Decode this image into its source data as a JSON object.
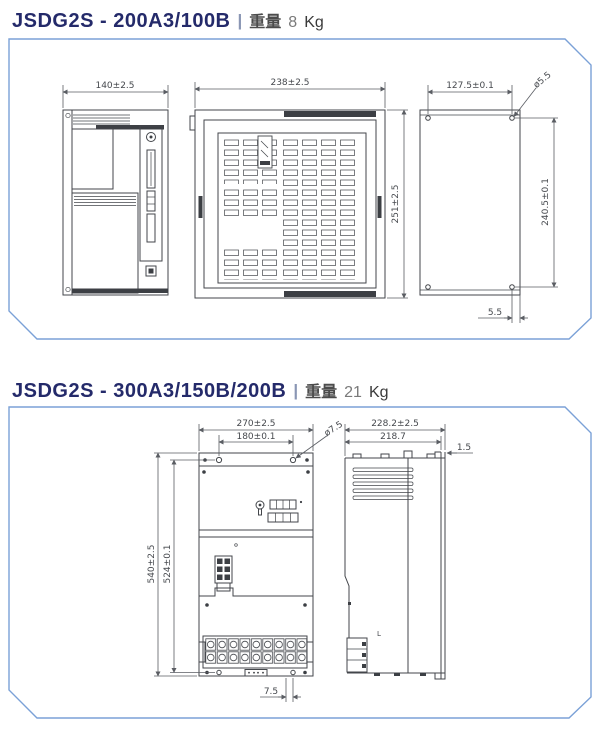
{
  "colors": {
    "model_text": "#242a6a",
    "separator": "#8a96b4",
    "weight_label_text": "#4c4c4c",
    "panel_border": "#7ba1d7",
    "drawing_line": "#43464b",
    "panel_bg": "#ffffff"
  },
  "sections": [
    {
      "title": {
        "model": "JSDG2S - 200A3/100B",
        "sep": "|",
        "weight_label": "重量",
        "weight_value": "8",
        "weight_unit": "Kg"
      },
      "dims": {
        "side_top": "140±2.5",
        "front_top": "238±2.5",
        "front_right": "251±2.5",
        "back_top": "127.5±0.1",
        "back_hole": "ø5.5",
        "back_right": "240.5±0.1",
        "back_bottom": "5.5"
      }
    },
    {
      "title": {
        "model": "JSDG2S - 300A3/150B/200B",
        "sep": "|",
        "weight_label": "重量",
        "weight_value": "21",
        "weight_unit": "Kg"
      },
      "dims": {
        "front_top": "270±2.5",
        "front_inner": "180±0.1",
        "front_hole": "ø7.5",
        "left_outer": "540±2.5",
        "left_inner": "524±0.1",
        "front_bottom": "7.5",
        "side_top": "228.2±2.5",
        "side_inner": "218.7",
        "side_right": "1.5",
        "side_mark": "L"
      }
    }
  ]
}
